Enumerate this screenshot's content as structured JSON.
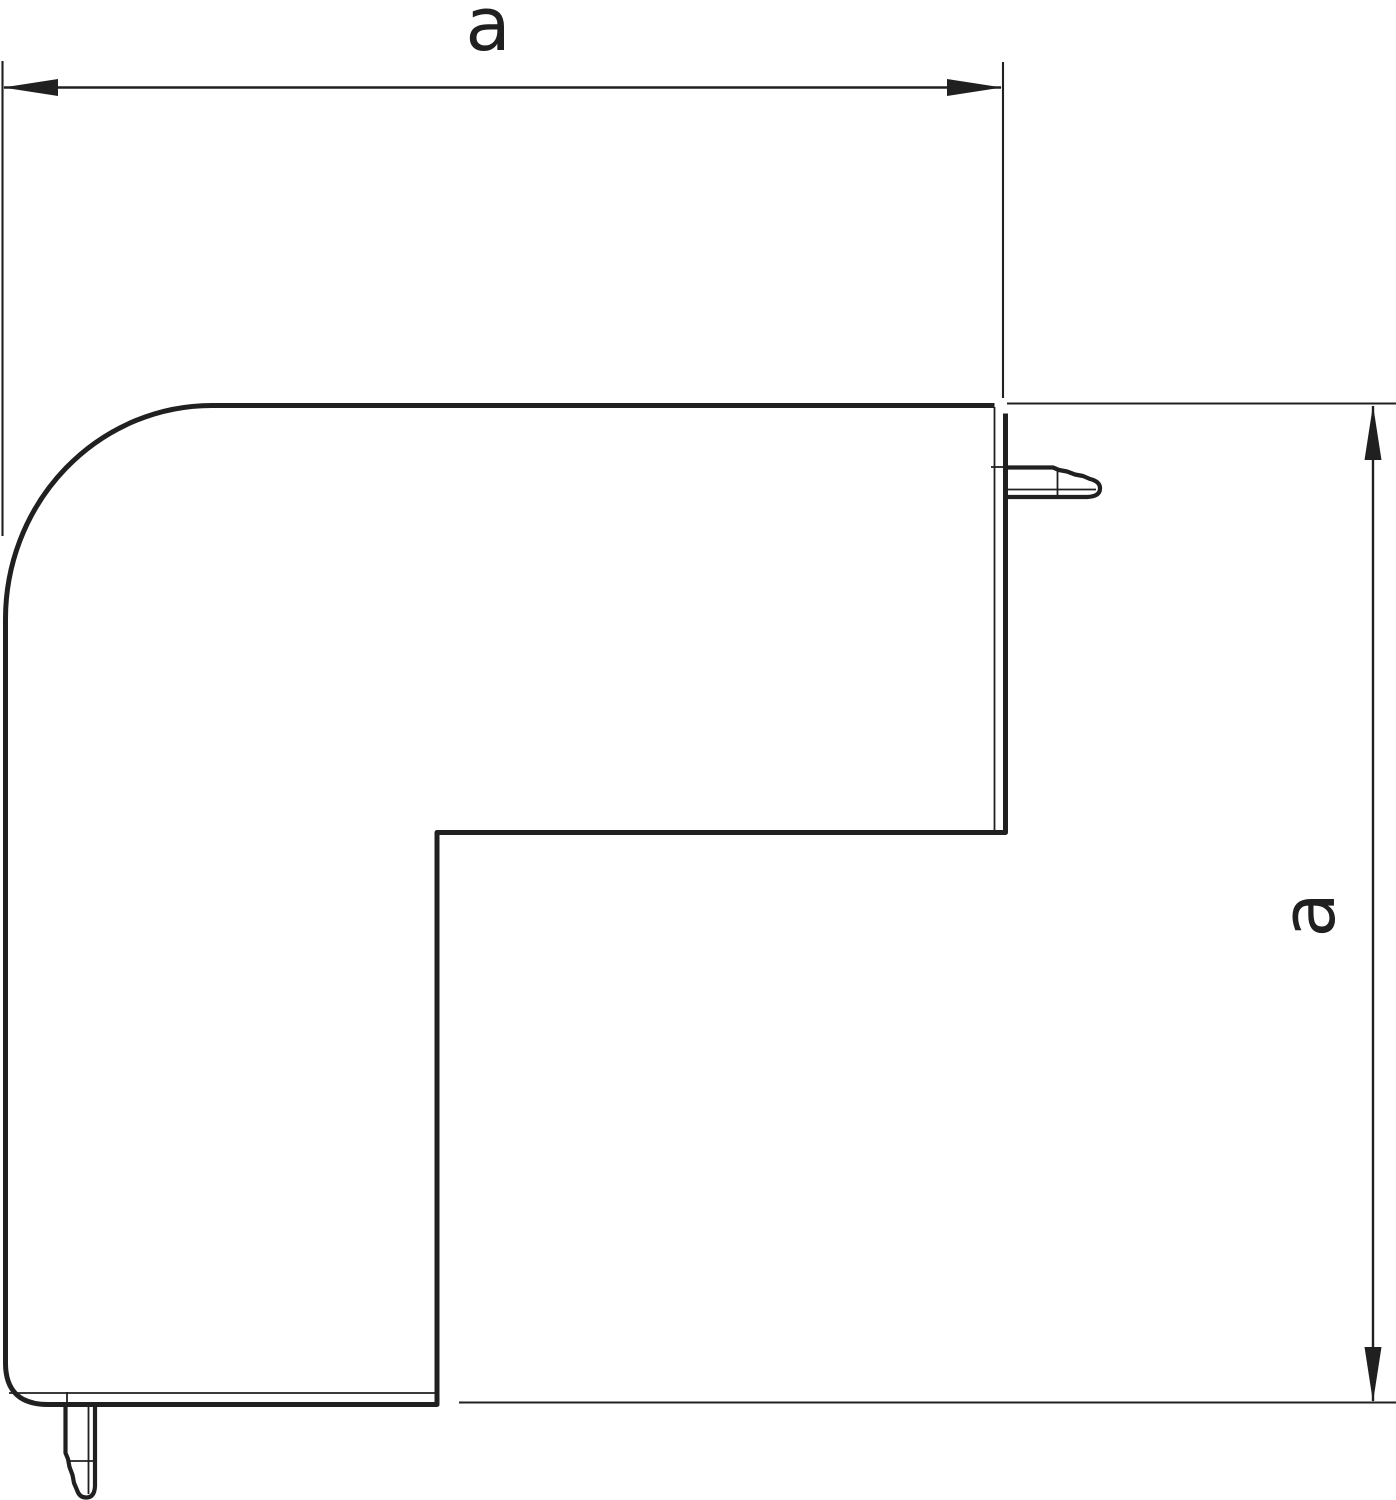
{
  "colors": {
    "background": "#ffffff",
    "line": "#202020"
  },
  "dimensions": {
    "width": {
      "label": "a"
    },
    "height": {
      "label": "a"
    }
  }
}
